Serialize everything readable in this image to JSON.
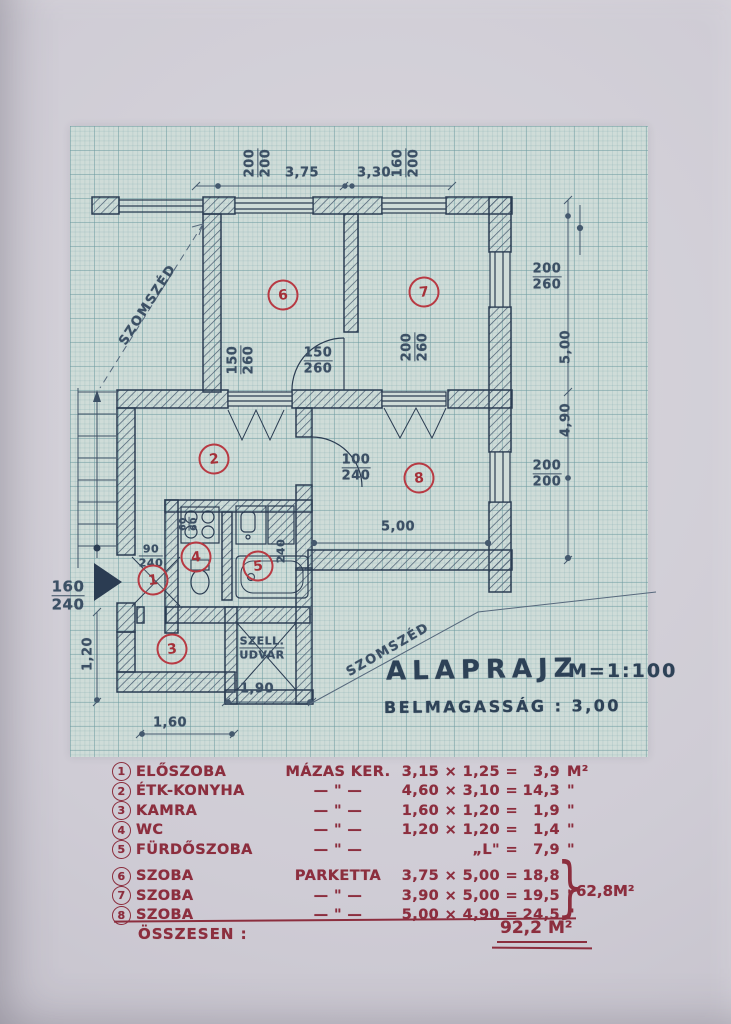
{
  "plan": {
    "title": "ALAPRAJZ",
    "scale": "M=1:100",
    "subtitle": "BELMAGASSÁG : 3,00",
    "neighbor_label_1": "SZOMSZÉD",
    "neighbor_label_2": "SZOMSZÉD",
    "vent_court": {
      "line1": "SZELL.",
      "line2": "UDVAR"
    },
    "rooms": [
      "1",
      "2",
      "3",
      "4",
      "5",
      "6",
      "7",
      "8"
    ],
    "dims": {
      "top_win_left": {
        "num": "200",
        "den": "200"
      },
      "top_width_left": "3,75",
      "top_width_right": "3,30",
      "top_win_right": {
        "num": "160",
        "den": "200"
      },
      "right_win_top": {
        "num": "200",
        "den": "260"
      },
      "right_height_top": "5,00",
      "right_height_bottom": "4,90",
      "right_win_bottom": {
        "num": "200",
        "den": "200"
      },
      "room7_win": {
        "num": "200",
        "den": "260"
      },
      "room6_win": {
        "num": "150",
        "den": "260"
      },
      "room6_door": {
        "num": "150",
        "den": "260"
      },
      "room8_door": {
        "num": "100",
        "den": "240"
      },
      "room8_width": "5,00",
      "entry_door": {
        "num": "160",
        "den": "240"
      },
      "hall_door": {
        "num": "90",
        "den": "240"
      },
      "stove": {
        "num": "60",
        "den": "60"
      },
      "bath_door": "240",
      "left_height": "1,20",
      "bottom_width": "1,60",
      "court_width": "1,90"
    },
    "colors": {
      "ink": "#2b3c52",
      "pencil": "#3c5065",
      "red": "#b83a43",
      "legend_red": "#8c2e3e",
      "paper": "#cfccd5",
      "graph": "#cfdcd8"
    }
  },
  "legend": {
    "rows": [
      {
        "num": "1",
        "name": "ELŐSZOBA",
        "floor": "MÁZAS KER.",
        "calc": "3,15 × 1,25 =",
        "area": "3,9",
        "unit": "M²"
      },
      {
        "num": "2",
        "name": "ÉTK-KONYHA",
        "floor": "— \" —",
        "calc": "4,60 × 3,10 =",
        "area": "14,3",
        "unit": "\""
      },
      {
        "num": "3",
        "name": "KAMRA",
        "floor": "— \" —",
        "calc": "1,60 × 1,20 =",
        "area": "1,9",
        "unit": "\""
      },
      {
        "num": "4",
        "name": "WC",
        "floor": "— \" —",
        "calc": "1,20 × 1,20 =",
        "area": "1,4",
        "unit": "\""
      },
      {
        "num": "5",
        "name": "FÜRDŐSZOBA",
        "floor": "— \" —",
        "calc": "„L\" =",
        "area": "7,9",
        "unit": "\""
      },
      {
        "num": "6",
        "name": "SZOBA",
        "floor": "PARKETTA",
        "calc": "3,75 × 5,00 =",
        "area": "18,8",
        "unit": ""
      },
      {
        "num": "7",
        "name": "SZOBA",
        "floor": "— \" —",
        "calc": "3,90 × 5,00 =",
        "area": "19,5",
        "unit": "\""
      },
      {
        "num": "8",
        "name": "SZOBA",
        "floor": "— \" —",
        "calc": "5,00 × 4,90 =",
        "area": "24,5",
        "unit": "\""
      }
    ],
    "brace_glyph": "}",
    "subtotal": "62,8M²",
    "total_label": "ÖSSZESEN :",
    "total_value": "92,2",
    "total_unit": "M²"
  }
}
